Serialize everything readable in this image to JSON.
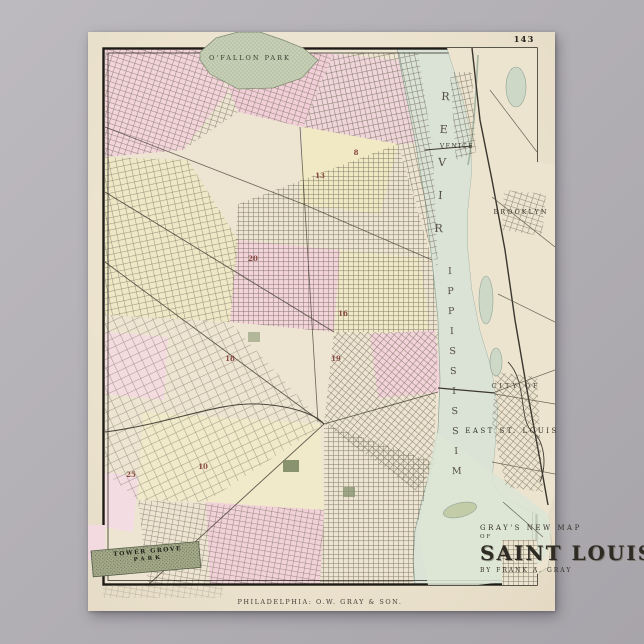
{
  "artwork": {
    "type": "vintage-map-poster",
    "page_number": "143",
    "imprint": "PHILADELPHIA: O.W. GRAY & SON."
  },
  "title_block": {
    "kicker": "GRAY'S NEW MAP",
    "connector": "OF",
    "title": "SAINT LOUIS",
    "byline": "BY FRANK A. GRAY"
  },
  "labels": {
    "ofallon_park": "O'FALLON PARK",
    "tower_grove_line1": "TOWER GROVE",
    "tower_grove_line2": "PARK",
    "venice": "VENICE",
    "brooklyn": "BROOKLYN",
    "east_side_line1": "CITY OF",
    "east_side_line2": "EAST ST. LOUIS",
    "river_word_upper": "RIVER",
    "river_word_lower": "MISSISSIPPI"
  },
  "wards": [
    "20",
    "16",
    "18",
    "19",
    "25",
    "10",
    "13",
    "8"
  ],
  "colors": {
    "paper": "#ece3cf",
    "pink": "#f3d4da",
    "yellow": "#f0e9c4",
    "park_green": "#c6cfb5",
    "river": "#dbe3d7",
    "border_ink": "#1e1b16"
  }
}
